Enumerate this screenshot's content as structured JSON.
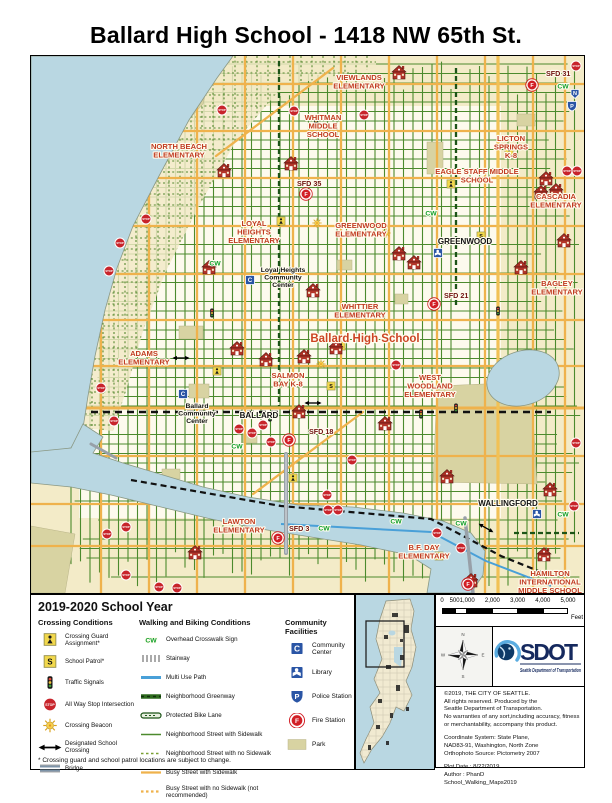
{
  "page": {
    "title": "Ballard High School - 1418 NW 65th St."
  },
  "legend": {
    "year": "2019-2020 School Year",
    "crossing": {
      "header": "Crossing Conditions",
      "items": [
        {
          "icon": "crossing-guard",
          "label": "Crossing Guard Assignment*"
        },
        {
          "icon": "school-patrol",
          "label": "School Patrol*"
        },
        {
          "icon": "traffic-signal",
          "label": "Traffic Signals"
        },
        {
          "icon": "stop-sign",
          "label": "All Way Stop Intersection"
        },
        {
          "icon": "crossing-beacon",
          "label": "Crossing Beacon"
        },
        {
          "icon": "school-crossing-arrow",
          "label": "Designated School Crossing"
        },
        {
          "icon": "bridge",
          "label": "Bridge"
        }
      ]
    },
    "walking": {
      "header": "Walking and Biking Conditions",
      "items": [
        {
          "icon": "cw",
          "label": "Overhead Crosswalk Sign"
        },
        {
          "icon": "stairway",
          "label": "Stairway"
        },
        {
          "icon": "multi-use-path",
          "label": "Multi Use Path"
        },
        {
          "icon": "greenway",
          "label": "Neighborhood Greenway"
        },
        {
          "icon": "protected-bike-lane",
          "label": "Protected Bike Lane"
        },
        {
          "icon": "street-sidewalk",
          "label": "Neighborhood Street with Sidewalk"
        },
        {
          "icon": "street-no-sidewalk",
          "label": "Neighborhood Street with no Sidewalk"
        },
        {
          "icon": "busy-sidewalk",
          "label": "Busy Street with Sidewalk"
        },
        {
          "icon": "busy-no-sidewalk",
          "label": "Busy Street with no Sidewalk (not recommended)"
        }
      ]
    },
    "community": {
      "header": "Community Facilities",
      "items": [
        {
          "icon": "community-center",
          "label": "Community Center"
        },
        {
          "icon": "library",
          "label": "Library"
        },
        {
          "icon": "police",
          "label": "Police Station"
        },
        {
          "icon": "fire",
          "label": "Fire Station"
        },
        {
          "icon": "park",
          "label": "Park"
        }
      ]
    },
    "footnote": "* Crossing guard and school patrol locations are subject to change."
  },
  "scalebar": {
    "ticks": [
      "0",
      "500",
      "1,000",
      "2,000",
      "3,000",
      "4,000",
      "5,000"
    ],
    "feet_values": [
      0,
      500,
      1000,
      2000,
      3000,
      4000,
      5000
    ],
    "unit": "Feet"
  },
  "compass": {
    "points": [
      "N",
      "E",
      "S",
      "W"
    ]
  },
  "logo": {
    "name": "SDOT",
    "subtitle": "Seattle Department of Transportation"
  },
  "credits": {
    "paragraphs": [
      [
        "©2019, THE CITY OF SEATTLE.",
        "All rights reserved. Produced by the",
        "Seattle Department of Transportation.",
        "No warranties of any sort,including accuracy, fitness",
        "or merchantability, accompany this product."
      ],
      [
        "Coordinate System: State Plane,",
        "NAD83-91, Washington, North Zone",
        "Orthophoto Source: Pictometry 2007"
      ],
      [
        "Plot Date : 8/22/2019",
        "Author : PhanD",
        "School_Walking_Maps2019"
      ]
    ]
  },
  "glyphs": {
    "stop": "STOP",
    "cw": "CW",
    "n": "N",
    "patrol": "S",
    "community_center": "C",
    "police": "P",
    "fire": "F"
  },
  "colors": {
    "water": "#b9d7e2",
    "land": "#f3ebc8",
    "park": "#d8d3a2",
    "street_green": "#4c8a2d",
    "street_busy": "#efb24c",
    "greenway": "#1c5417",
    "stop_red": "#c8242b",
    "school_red": "#b23428",
    "facility_blue": "#2a55a5",
    "fire_red": "#d21f26",
    "cw_green": "#13a02c",
    "sdot_navy": "#15295e",
    "sdot_blue": "#5aace0"
  },
  "map": {
    "labels": [
      {
        "t": "VIEWLANDS\nELEMENTARY",
        "x": 328,
        "y": 24,
        "c": "school"
      },
      {
        "t": "WHITMAN\nMIDDLE\nSCHOOL",
        "x": 292,
        "y": 64,
        "c": "school"
      },
      {
        "t": "NORTH BEACH\nELEMENTARY",
        "x": 148,
        "y": 93,
        "c": "school"
      },
      {
        "t": "LICTON\nSPRINGS\nK-8",
        "x": 480,
        "y": 85,
        "c": "school"
      },
      {
        "t": "EAGLE STAFF MIDDLE\nSCHOOL",
        "x": 446,
        "y": 118,
        "c": "school"
      },
      {
        "t": "CASCADIA\nELEMENTARY",
        "x": 525,
        "y": 143,
        "c": "school"
      },
      {
        "t": "BAGLEY\nELEMENTARY",
        "x": 526,
        "y": 230,
        "c": "school"
      },
      {
        "t": "LOYAL\nHEIGHTS\nELEMENTARY",
        "x": 223,
        "y": 170,
        "c": "school"
      },
      {
        "t": "GREENWOOD\nELEMENTARY",
        "x": 330,
        "y": 172,
        "c": "school"
      },
      {
        "t": "WHITTIER\nELEMENTARY",
        "x": 329,
        "y": 253,
        "c": "school"
      },
      {
        "t": "Ballard High School",
        "x": 334,
        "y": 286,
        "c": "big"
      },
      {
        "t": "ADAMS\nELEMENTARY",
        "x": 113,
        "y": 300,
        "c": "school"
      },
      {
        "t": "SALMON\nBAY K-8",
        "x": 257,
        "y": 322,
        "c": "school"
      },
      {
        "t": "WEST\nWOODLAND\nELEMENTARY",
        "x": 399,
        "y": 324,
        "c": "school"
      },
      {
        "t": "LAWTON\nELEMENTARY",
        "x": 208,
        "y": 468,
        "c": "school"
      },
      {
        "t": "B.F. DAY\nELEMENTARY",
        "x": 393,
        "y": 494,
        "c": "school"
      },
      {
        "t": "HAMILTON\nINTERNATIONAL\nMIDDLE SCHOOL",
        "x": 519,
        "y": 520,
        "c": "school"
      },
      {
        "t": "GREENWOOD",
        "x": 434,
        "y": 188,
        "c": "place"
      },
      {
        "t": "BALLARD",
        "x": 228,
        "y": 362,
        "c": "place"
      },
      {
        "t": "WALLINGFORD",
        "x": 477,
        "y": 450,
        "c": "place"
      },
      {
        "t": "Loyal Heights\nCommunity\nCenter",
        "x": 252,
        "y": 216,
        "c": "cc"
      },
      {
        "t": "Ballard\nCommunity\nCenter",
        "x": 166,
        "y": 352,
        "c": "cc"
      }
    ],
    "fire_stations": [
      {
        "label": "SFD 31",
        "x": 501,
        "y": 29,
        "lx": 515,
        "ly": 20
      },
      {
        "label": "SFD 35",
        "x": 275,
        "y": 138,
        "lx": 266,
        "ly": 130
      },
      {
        "label": "SFD 21",
        "x": 403,
        "y": 248,
        "lx": 413,
        "ly": 242
      },
      {
        "label": "SFD 18",
        "x": 258,
        "y": 384,
        "lx": 278,
        "ly": 378
      },
      {
        "label": "SFD 3",
        "x": 247,
        "y": 482,
        "lx": 258,
        "ly": 475
      },
      {
        "label": "SFD 9",
        "x": 437,
        "y": 528,
        "lx": 446,
        "ly": 545
      }
    ],
    "stops": [
      [
        115,
        163
      ],
      [
        89,
        187
      ],
      [
        78,
        215
      ],
      [
        70,
        332
      ],
      [
        83,
        365
      ],
      [
        95,
        471
      ],
      [
        76,
        478
      ],
      [
        95,
        519
      ],
      [
        128,
        531
      ],
      [
        146,
        532
      ],
      [
        191,
        54
      ],
      [
        263,
        55
      ],
      [
        333,
        59
      ],
      [
        536,
        115
      ],
      [
        546,
        115
      ],
      [
        545,
        387
      ],
      [
        365,
        309
      ],
      [
        406,
        477
      ],
      [
        430,
        492
      ],
      [
        543,
        450
      ],
      [
        208,
        373
      ],
      [
        221,
        377
      ],
      [
        232,
        369
      ],
      [
        240,
        386
      ],
      [
        321,
        404
      ],
      [
        296,
        439
      ],
      [
        297,
        454
      ],
      [
        307,
        454
      ],
      [
        545,
        10
      ]
    ],
    "schools": [
      [
        368,
        17
      ],
      [
        193,
        115
      ],
      [
        260,
        108
      ],
      [
        515,
        123
      ],
      [
        525,
        135
      ],
      [
        510,
        137
      ],
      [
        178,
        212
      ],
      [
        282,
        235
      ],
      [
        368,
        198
      ],
      [
        383,
        207
      ],
      [
        533,
        185
      ],
      [
        490,
        212
      ],
      [
        206,
        293
      ],
      [
        235,
        304
      ],
      [
        273,
        301
      ],
      [
        268,
        356
      ],
      [
        354,
        368
      ],
      [
        416,
        421
      ],
      [
        164,
        497
      ],
      [
        440,
        525
      ],
      [
        513,
        499
      ],
      [
        519,
        434
      ],
      [
        305,
        292
      ]
    ],
    "signals": [
      [
        239,
        361
      ],
      [
        390,
        358
      ],
      [
        467,
        255
      ],
      [
        285,
        65
      ],
      [
        181,
        257
      ],
      [
        425,
        352
      ]
    ],
    "guards": [
      [
        250,
        165
      ],
      [
        310,
        290
      ],
      [
        186,
        315
      ],
      [
        420,
        128
      ],
      [
        262,
        422
      ],
      [
        408,
        500
      ],
      [
        478,
        96
      ]
    ],
    "patrols": [
      [
        300,
        330
      ],
      [
        450,
        180
      ]
    ],
    "beacons": [
      [
        286,
        167
      ],
      [
        355,
        177
      ],
      [
        290,
        308
      ]
    ],
    "arrows": [
      [
        150,
        302,
        0
      ],
      [
        282,
        347,
        0
      ],
      [
        455,
        472,
        30
      ]
    ],
    "cw": [
      [
        532,
        30
      ],
      [
        400,
        157
      ],
      [
        184,
        207
      ],
      [
        206,
        390
      ],
      [
        293,
        472
      ],
      [
        430,
        467
      ],
      [
        532,
        458
      ],
      [
        365,
        465
      ]
    ],
    "police": [
      [
        541,
        50
      ]
    ],
    "n_markers": [
      [
        544,
        38
      ]
    ],
    "libraries": [
      [
        407,
        197
      ],
      [
        506,
        458
      ]
    ],
    "community_centers": [
      [
        219,
        224
      ],
      [
        152,
        338
      ]
    ]
  }
}
